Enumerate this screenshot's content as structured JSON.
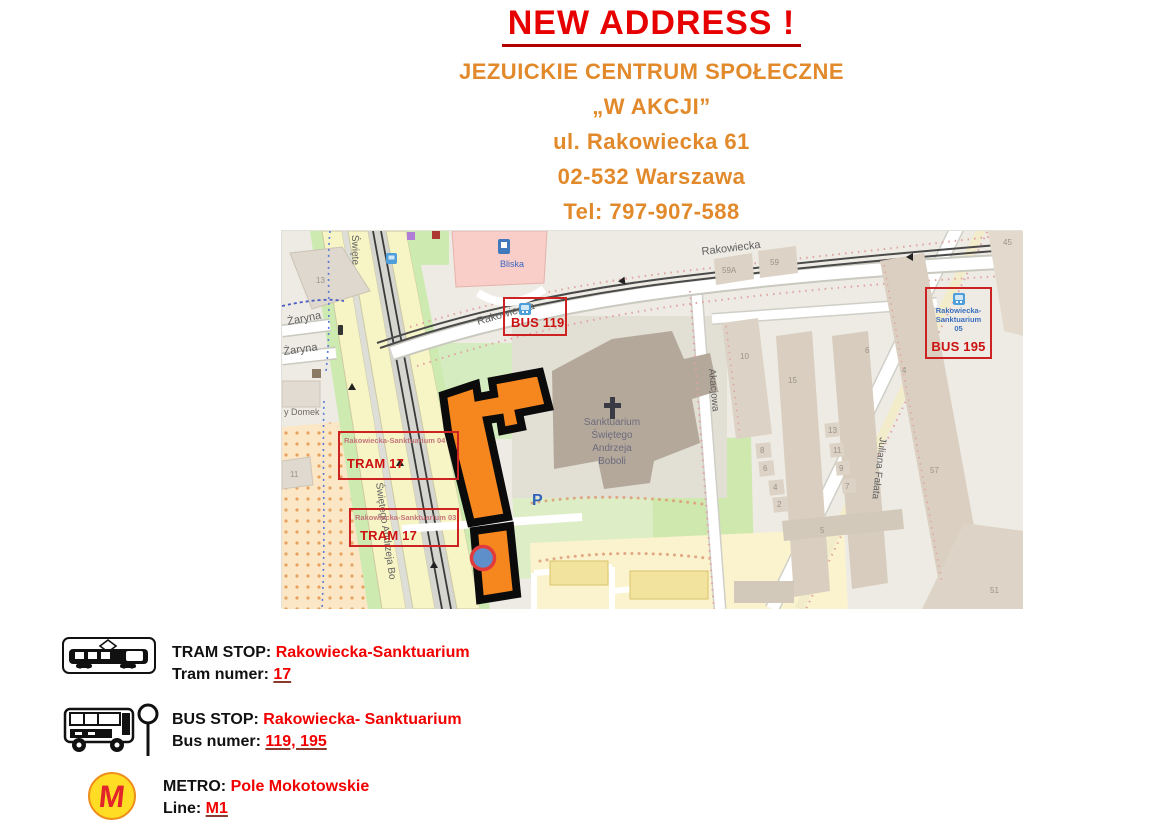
{
  "header": {
    "title": "NEW ADDRESS !",
    "org_line1": "JEZUICKIE CENTRUM SPOŁECZNE",
    "org_line2": "„W AKCJI”",
    "address_line1": "ul. Rakowiecka 61",
    "address_line2": "02-532 Warszawa",
    "phone": "Tel: 797-907-588"
  },
  "map": {
    "streets": {
      "rakowiecka_w": "Rakowiecka",
      "rakowiecka_e": "Rakowiecka",
      "zaryna_n": "Żaryna",
      "zaryna_s": "Żaryna",
      "swietego_top": "Święte",
      "swietego_andrzeja": "Świętego Andrzeja Bo",
      "akacjowa": "Akacjowa",
      "juliana_falata": "Juliana Fałata"
    },
    "places": {
      "bliska": "Bliska",
      "domek": "y Domek",
      "parking": "P",
      "church": [
        "Sanktuarium",
        "Świętego",
        "Andrzeja",
        "Boboli"
      ]
    },
    "house_numbers": [
      "13",
      "11",
      "59A",
      "59",
      "10",
      "15",
      "6",
      "8",
      "6",
      "4",
      "2",
      "13",
      "11",
      "9",
      "7",
      "5",
      "4",
      "57",
      "45",
      "51"
    ],
    "annotations": {
      "bus119": {
        "label": "BUS 119"
      },
      "tram17_north": {
        "stop": "Rakowiecka-Sanktuarium 04",
        "label": "TRAM 17"
      },
      "tram17_south": {
        "stop": "Rakowiecka-Sanktuarium 03",
        "label": "TRAM 17"
      },
      "bus195": {
        "stop_lines": [
          "Rakowiecka-",
          "Sanktuarium",
          "05"
        ],
        "label": "BUS 195"
      }
    }
  },
  "legend": {
    "tram": {
      "stop_label": "TRAM STOP:",
      "stop_value": "Rakowiecka-Sanktuarium",
      "num_label": "Tram numer:",
      "num_value": "17"
    },
    "bus": {
      "stop_label": "BUS STOP:",
      "stop_value": "Rakowiecka- Sanktuarium",
      "num_label": "Bus numer:",
      "num_value": "119, 195"
    },
    "metro": {
      "stop_label": "METRO:",
      "stop_value": "Pole Mokotowskie",
      "num_label": "Line:",
      "num_value": "M1",
      "logo_letter": "M"
    }
  },
  "colors": {
    "title_red": "#e60000",
    "header_orange": "#e28a2b",
    "legend_red": "#f20000",
    "annotation_red": "#cc2222",
    "building_highlight_orange": "#f6871f",
    "marker_blue": "#5e8fcb",
    "metro_yellow": "#ffdd24",
    "metro_red": "#e2242b"
  }
}
